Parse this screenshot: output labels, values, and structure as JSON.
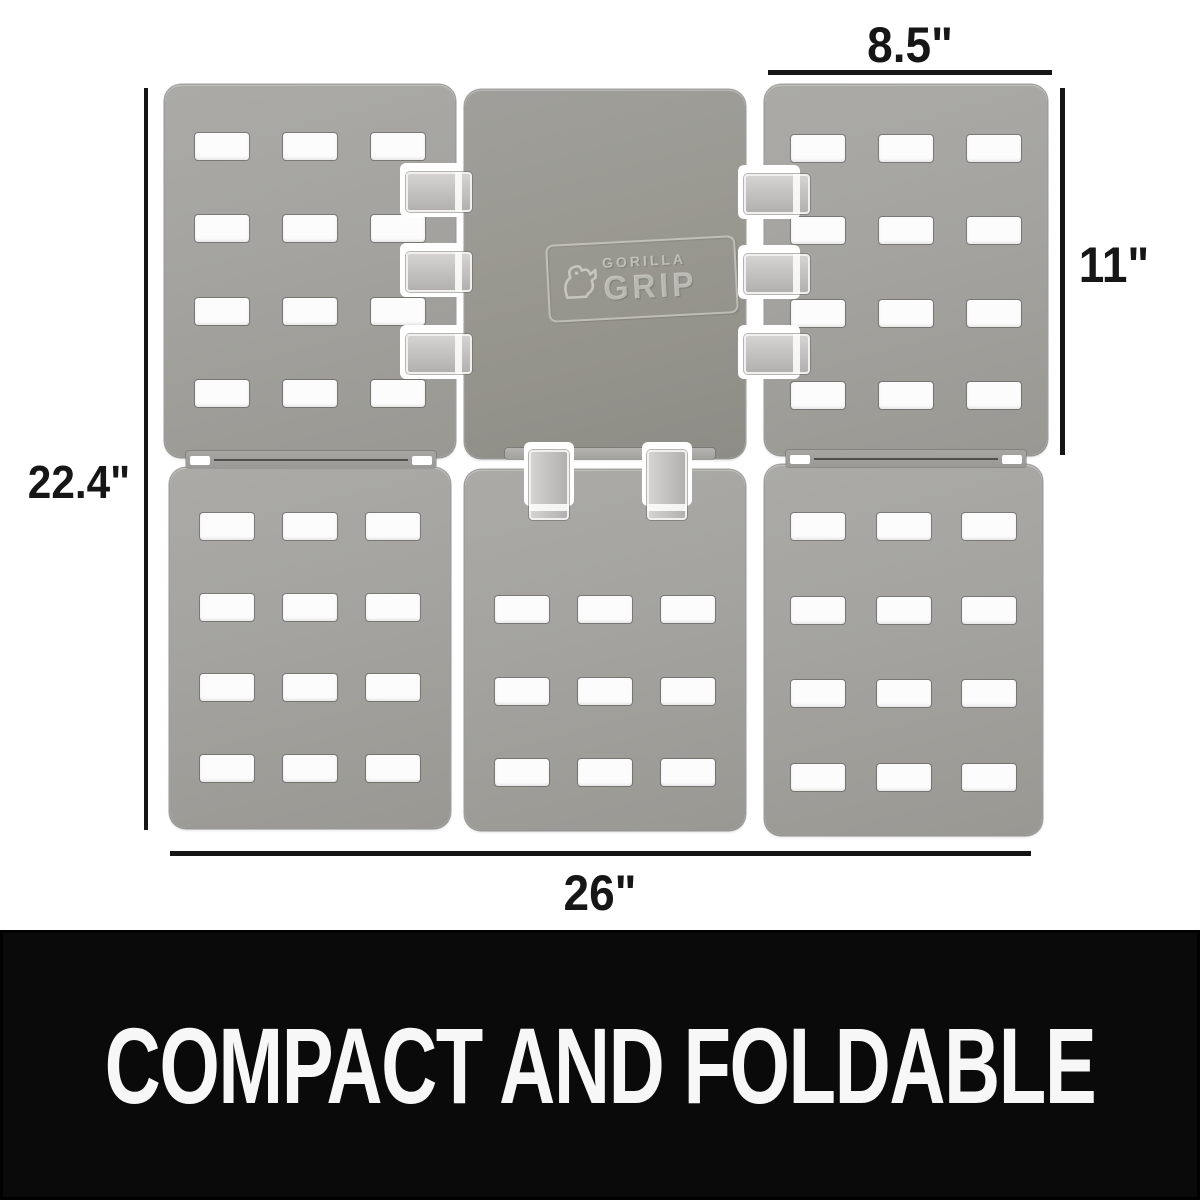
{
  "dimensions": {
    "panel_width": "8.5\"",
    "panel_height": "11\"",
    "unfolded_height": "22.4\"",
    "unfolded_width": "26\""
  },
  "logo": {
    "line1": "GORILLA",
    "line2": "GRIP"
  },
  "banner": {
    "text": "COMPACT AND FOLDABLE"
  },
  "panels": {
    "tl": {
      "rows": 4,
      "cols": 3
    },
    "tm": {
      "rows": 0,
      "cols": 0
    },
    "tr": {
      "rows": 4,
      "cols": 3
    },
    "bl": {
      "rows": 4,
      "cols": 3
    },
    "bm": {
      "rows": 3,
      "cols": 3
    },
    "br": {
      "rows": 4,
      "cols": 3
    }
  },
  "colors": {
    "background": "#ffffff",
    "panel": "#a4a39f",
    "panel_dark": "#98978f",
    "slot": "#fcfcfc",
    "clip": "#c9c8c6",
    "dimension": "#161616",
    "banner_bg": "#0a0a0a",
    "banner_text": "#f7f7f7"
  }
}
